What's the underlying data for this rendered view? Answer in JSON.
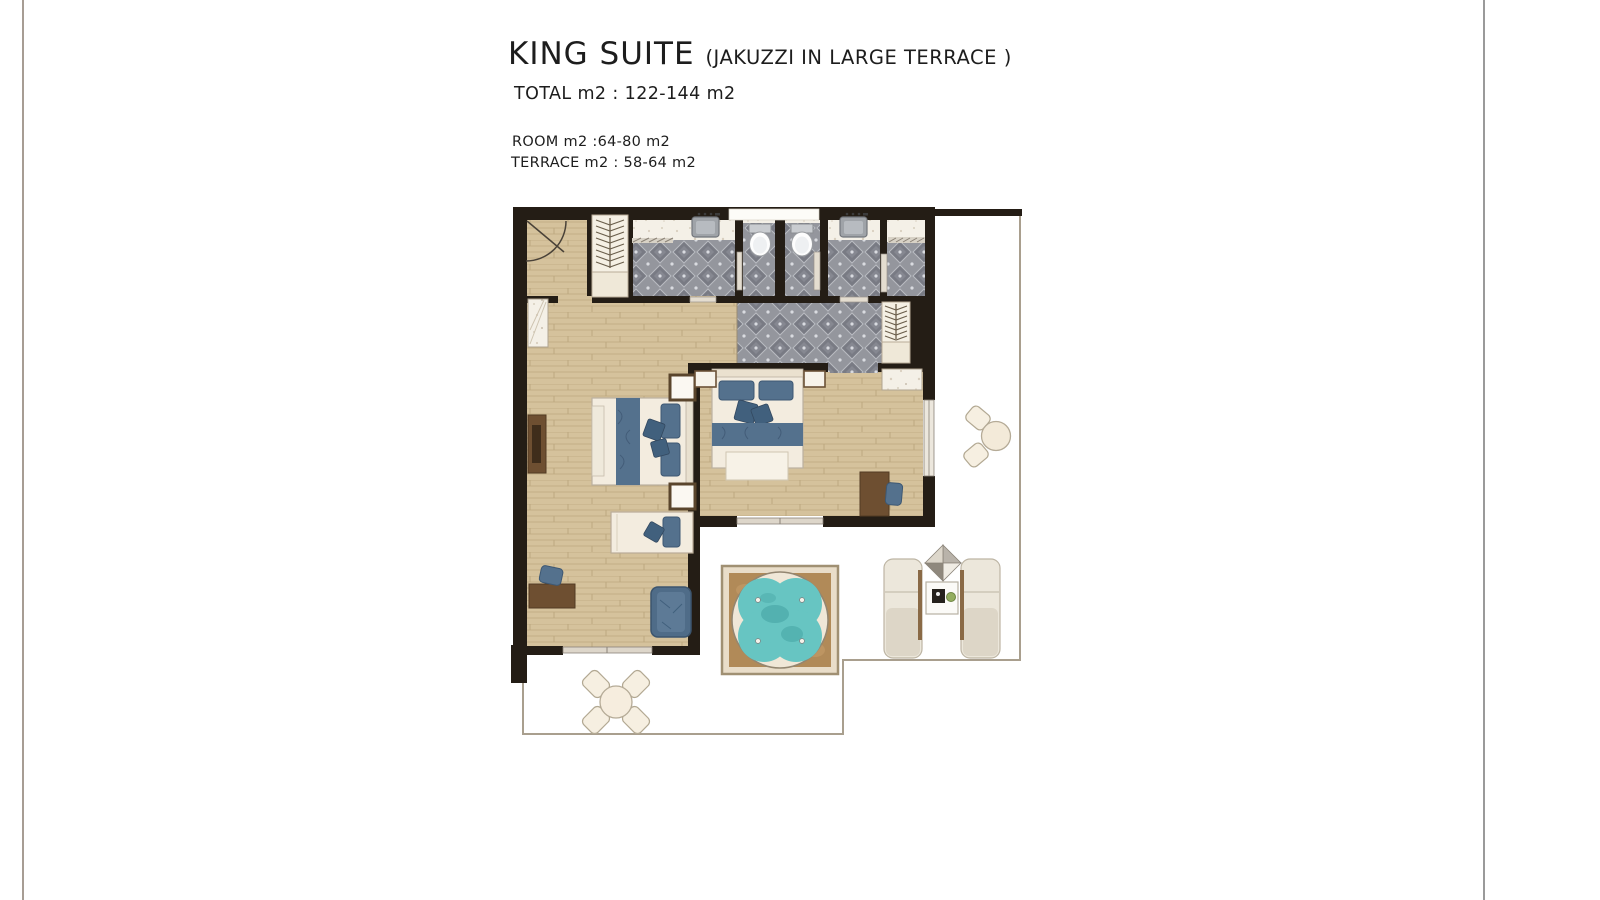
{
  "header": {
    "title": "KING SUITE",
    "title_note": "(JAKUZZI IN LARGE TERRACE )",
    "total": "TOTAL m2 : 122-144 m2",
    "room": "ROOM m2 :64-80 m2",
    "terrace": "TERRACE m2 : 58-64 m2"
  },
  "floor_plan": {
    "elements": [
      "entry-door",
      "closet-hangers",
      "bathroom",
      "shower",
      "sink-vanity",
      "wc-toilet",
      "wardrobe-hangers",
      "dressing-area",
      "living-room",
      "bedroom",
      "king-bed",
      "single-bed",
      "daybed",
      "armchair",
      "desk",
      "desk-chair",
      "tv-unit",
      "nightstand",
      "window",
      "sliding-door",
      "terrace",
      "jacuzzi",
      "sun-lounger",
      "parasol",
      "side-table",
      "dining-table",
      "dining-chair",
      "bistro-table",
      "bistro-chair"
    ]
  },
  "colors": {
    "rule-left": "#a79d94",
    "rule-right": "#9a9a9a",
    "wall": "#241d15",
    "wood": "#d5c29c",
    "wood-line": "#bda87f",
    "bath-tile": "#94969d",
    "bath-tile-dark": "#797b84",
    "marble": "#f4f0e7",
    "terr-a": "#c7b591",
    "terr-b": "#ab9770",
    "terr-c": "#d6c9af",
    "grout": "#8f7d5f",
    "jacuzzi-water": "#67c5c2",
    "jacuzzi-water-dark": "#3f9d9d",
    "jacuzzi-deck": "#b18a58",
    "furn-blue": "#54718d",
    "furn-blue-dark": "#41607d",
    "furn-brown": "#6e4f31",
    "furn-cream": "#f3ecdf",
    "door-leaf": "#e4ddd0",
    "rail": "#a99f8e",
    "text": "#1d1d1d"
  }
}
